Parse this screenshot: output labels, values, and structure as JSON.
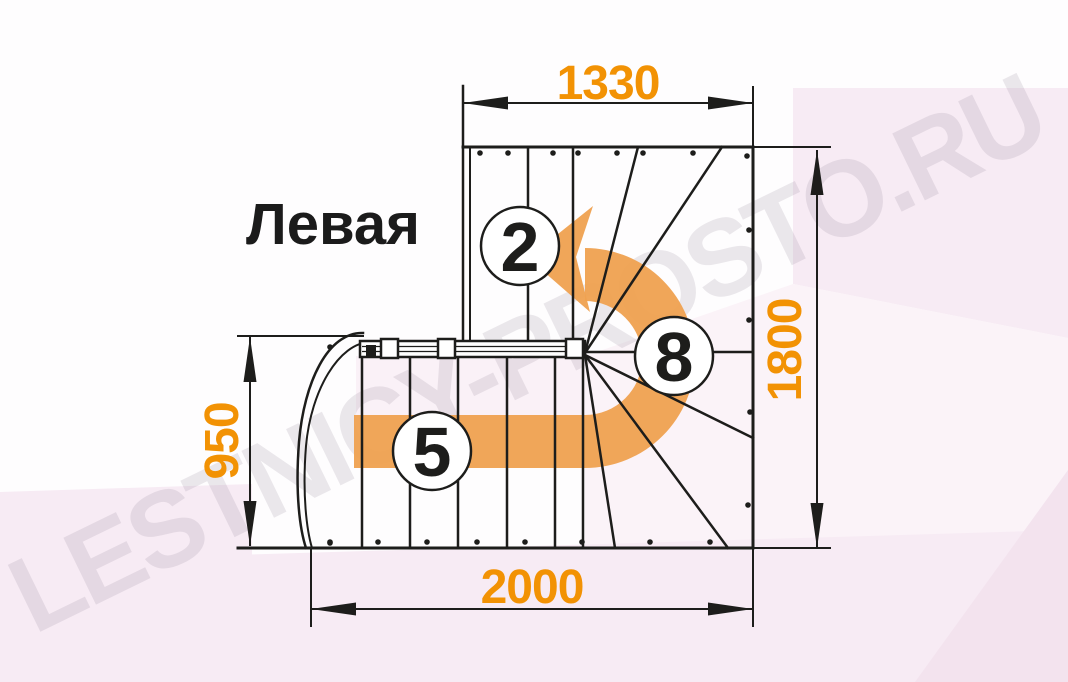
{
  "title": "Левая",
  "watermark": "LESTNICY-PROSTO.RU",
  "dimensions": {
    "top_width": "1330",
    "right_height": "1800",
    "left_height": "950",
    "bottom_width": "2000"
  },
  "step_markers": {
    "upper_flight": "2",
    "lower_flight": "5",
    "winder": "8"
  },
  "diagram": {
    "type": "staircase-plan-view",
    "turn_direction": "left (counterclockwise, arrow exits to the left at top)",
    "lower_flight_straight_treads": 6,
    "upper_flight_straight_treads": 3,
    "winder_treads_fan": 6,
    "dimensions_mm": {
      "upper_flight_width": 1330,
      "overall_depth": 1800,
      "lower_flight_depth": 950,
      "overall_width": 2000
    }
  },
  "colors": {
    "dimension_text": "#F29204",
    "direction_arrow": "#EFA150",
    "drawing_lines": "#1D1D1B",
    "background_pink": "#F7EBF4",
    "watermark_gray": "#887C8C"
  }
}
